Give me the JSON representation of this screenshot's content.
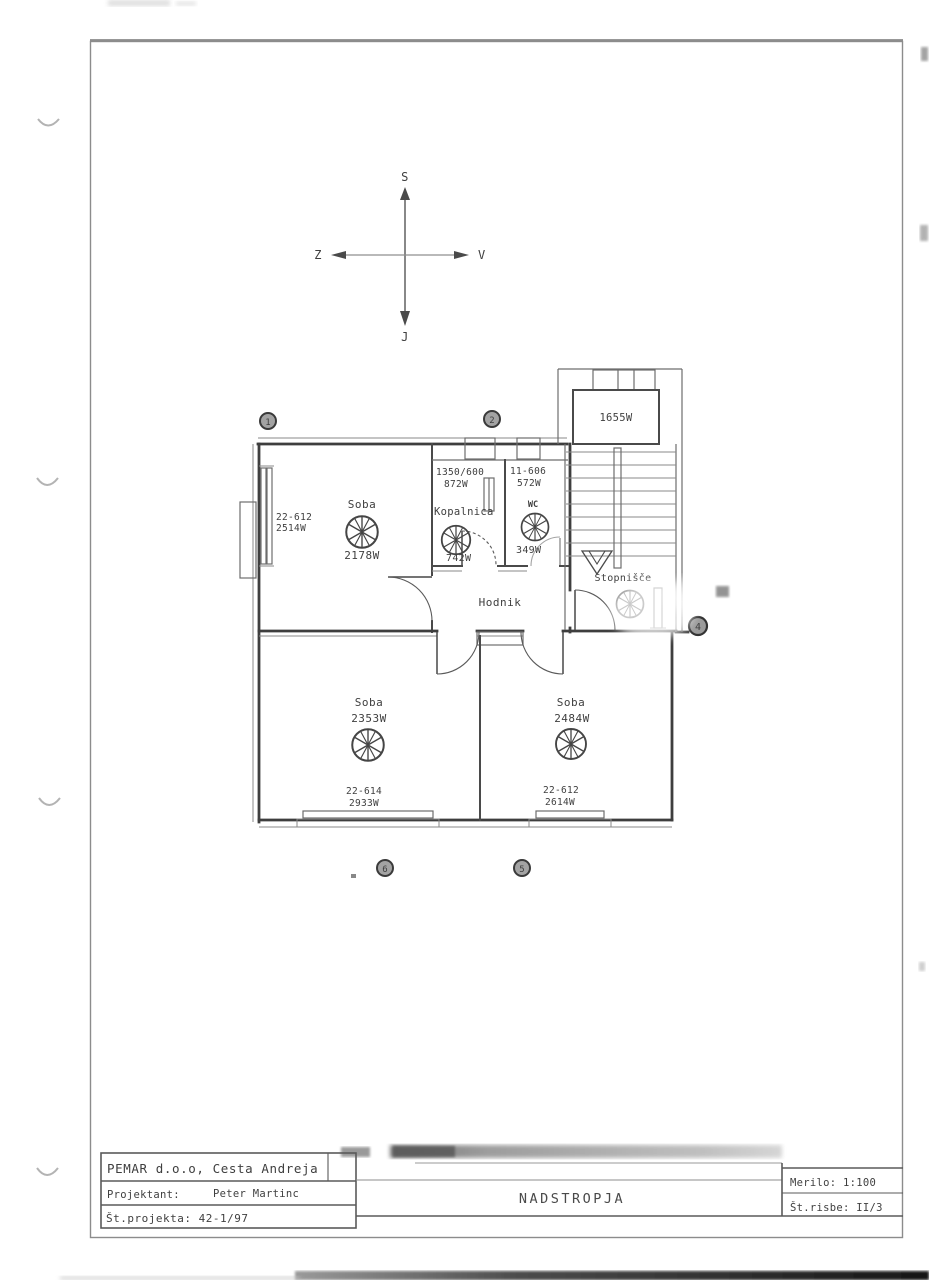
{
  "doc": {
    "drawing_title": "NADSTROPJA",
    "compass": {
      "north": "S",
      "south": "J",
      "east": "V",
      "west": "Z"
    },
    "grid_markers": {
      "top_left": "1",
      "top_right": "2",
      "right": "4",
      "bottom_left": "6",
      "bottom_right": "5"
    },
    "rooms": {
      "soba_nw": {
        "name": "Soba",
        "heat_load": "2178W",
        "radiator_type": "22-612",
        "radiator_power": "2514W"
      },
      "kopalnica": {
        "name": "Kopalnica",
        "heat_load": "742W",
        "radiator_type": "1350/600",
        "radiator_power": "872W"
      },
      "wc": {
        "name": "WC",
        "heat_load": "349W",
        "radiator_type": "11-606",
        "radiator_power": "572W"
      },
      "stopnisce": {
        "name": "Stopnišče",
        "heat_load": "1655W"
      },
      "hodnik": {
        "name": "Hodnik"
      },
      "soba_sw": {
        "name": "Soba",
        "heat_load": "2353W",
        "radiator_type": "22-614",
        "radiator_power": "2933W"
      },
      "soba_se": {
        "name": "Soba",
        "heat_load": "2484W",
        "radiator_type": "22-612",
        "radiator_power": "2614W"
      }
    },
    "title_block": {
      "company": "PEMAR d.o.o, Cesta Andreja",
      "designer_label": "Projektant:",
      "designer_name": "Peter Martinc",
      "project_number": "Št.projekta: 42-1/97",
      "scale": "Merilo: 1:100",
      "sheet_number": "Št.risbe: II/3"
    }
  }
}
